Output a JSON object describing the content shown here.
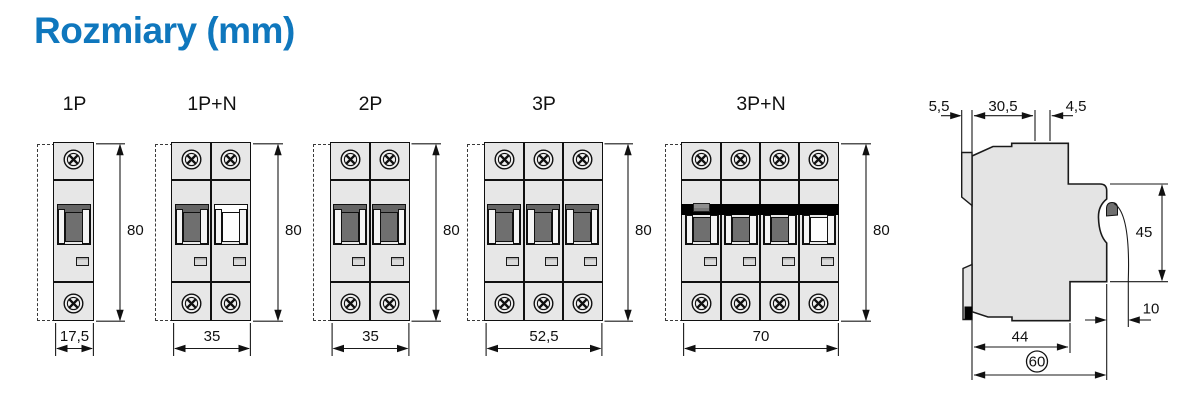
{
  "title": "Rozmiary (mm)",
  "accent_color": "#0f77bd",
  "unit": "mm",
  "breakers": [
    {
      "label": "1P",
      "width_mm": "17,5",
      "height_mm": "80"
    },
    {
      "label": "1P+N",
      "width_mm": "35",
      "height_mm": "80"
    },
    {
      "label": "2P",
      "width_mm": "35",
      "height_mm": "80"
    },
    {
      "label": "3P",
      "width_mm": "52,5",
      "height_mm": "80"
    },
    {
      "label": "3P+N",
      "width_mm": "70",
      "height_mm": "80"
    }
  ],
  "side_view": {
    "rail_offset_mm": "5,5",
    "mounting_depth_mm": "30,5",
    "handle_step_mm": "4,5",
    "front_face_height_mm": "45",
    "handle_protrusion_mm": "10",
    "base_depth_mm": "44",
    "total_depth_mm": "60"
  }
}
